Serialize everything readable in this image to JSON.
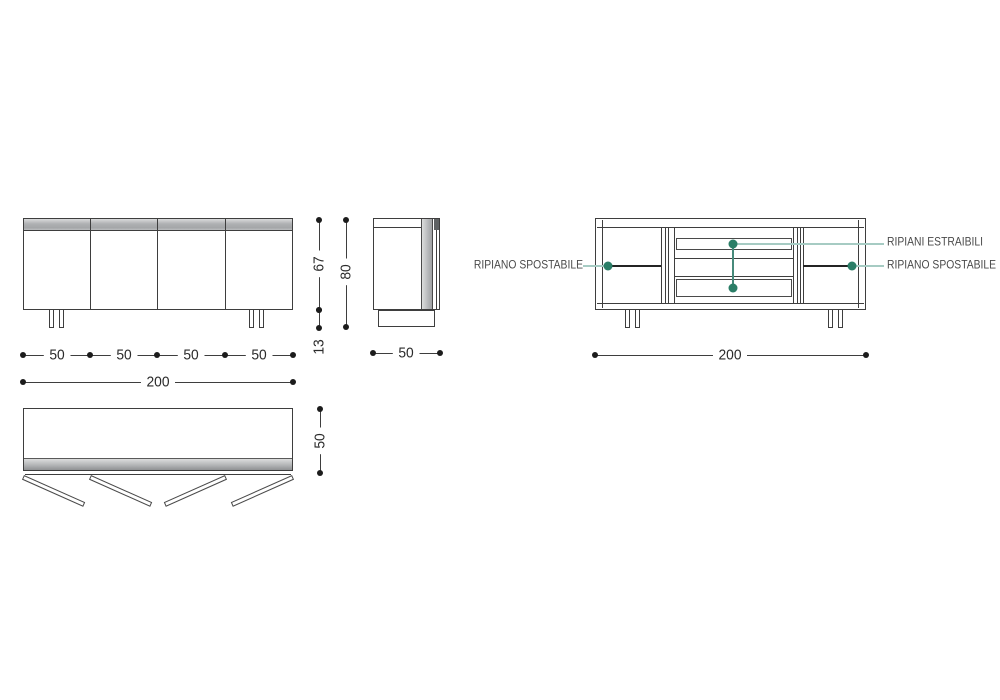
{
  "drawing": {
    "front_view": {
      "door_widths": [
        "50",
        "50",
        "50",
        "50"
      ],
      "total_width": "200",
      "body_height": "67",
      "leg_height": "13"
    },
    "side_view": {
      "overall_height": "80",
      "depth": "50"
    },
    "top_view": {
      "depth": "50"
    },
    "internal_view": {
      "total_width": "200",
      "annotations": {
        "left_shelf": "RIPIANO SPOSTABILE",
        "pullout_shelves": "RIPIANI ESTRAIBILI",
        "right_shelf": "RIPIANO SPOSTABILE"
      }
    },
    "colors": {
      "line": "#3e3e3e",
      "marker_dot": "#2b7e67",
      "leader_light": "#a6cbc3",
      "leader_dark": "#478a7b"
    }
  }
}
